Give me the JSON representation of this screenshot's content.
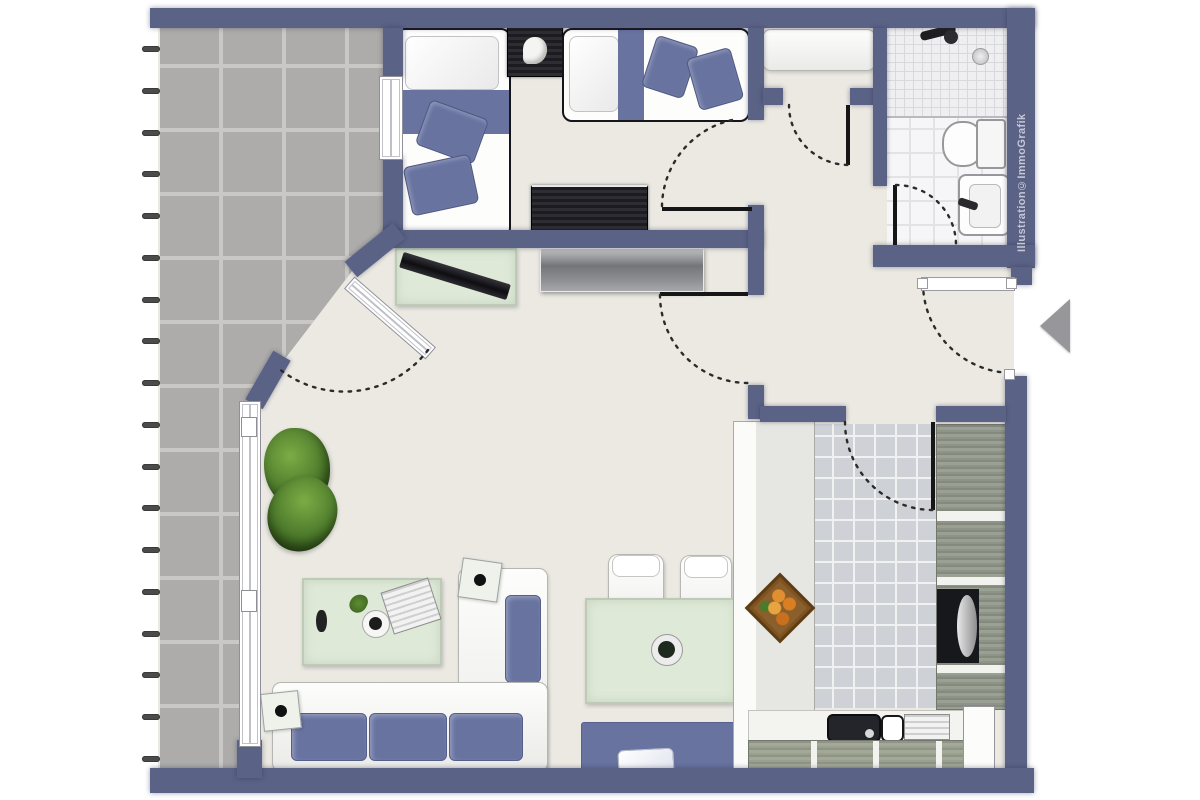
{
  "watermark": "Illustration©ImmoGrafik",
  "colors": {
    "wall": "#5a6286",
    "floor": "#ebe9e2",
    "tile": "#adacaa",
    "tile-joint": "#c9c8c4",
    "navy": "#6873a0",
    "glass": "#dfe9d8",
    "glass-border": "#bccab6",
    "ktile": "#ced1d5",
    "arc": "#2b2b2b",
    "watermark": "#c3c8d4"
  },
  "terrace": {
    "railing_tick_count": 18
  },
  "furniture_icons": [
    "single-bed",
    "single-bed",
    "nightstand",
    "dresser",
    "tv-board",
    "sideboard",
    "corner-sofa",
    "coffee-table",
    "side-table",
    "side-table",
    "plant",
    "plant",
    "dining-table",
    "chair",
    "chair",
    "bench",
    "wardrobe-bench",
    "kitchen-counter",
    "fruit-basket",
    "kitchen-cabinets",
    "oven",
    "sink",
    "shower",
    "toilet",
    "washbasin"
  ],
  "entrance": {
    "arrow_direction": "left"
  }
}
